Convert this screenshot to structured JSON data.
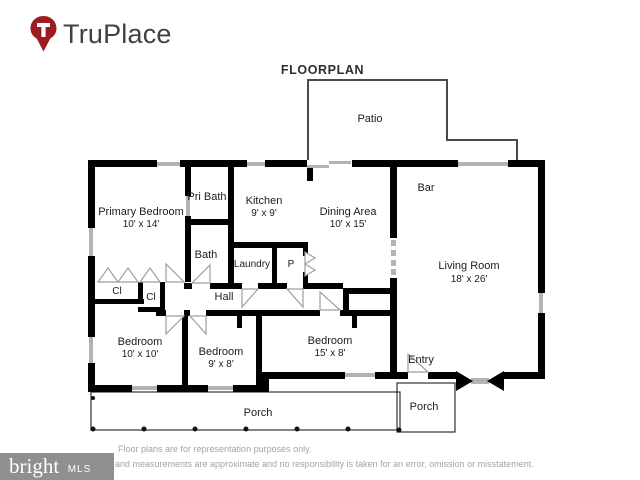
{
  "header": {
    "logo_text": "TruPlace"
  },
  "title": "FLOORPLAN",
  "rooms": {
    "patio": {
      "name": "Patio"
    },
    "bar": {
      "name": "Bar"
    },
    "pri_bath": {
      "name": "Pri Bath"
    },
    "kitchen": {
      "name": "Kitchen",
      "dims": "9' x 9'"
    },
    "dining": {
      "name": "Dining Area",
      "dims": "10' x 15'"
    },
    "primary_bedroom": {
      "name": "Primary Bedroom",
      "dims": "10' x 14'"
    },
    "bath": {
      "name": "Bath"
    },
    "laundry": {
      "name": "Laundry"
    },
    "pantry": {
      "name": "P"
    },
    "closet1": {
      "name": "Cl"
    },
    "closet2": {
      "name": "Cl"
    },
    "hall": {
      "name": "Hall"
    },
    "living_room": {
      "name": "Living Room",
      "dims": "18' x 26'"
    },
    "bedroom1": {
      "name": "Bedroom",
      "dims": "10' x 10'"
    },
    "bedroom2": {
      "name": "Bedroom",
      "dims": "9' x 8'"
    },
    "bedroom3": {
      "name": "Bedroom",
      "dims": "15' x 8'"
    },
    "entry": {
      "name": "Entry"
    },
    "porch_front": {
      "name": "Porch"
    },
    "porch_entry": {
      "name": "Porch"
    }
  },
  "footer": {
    "line1": "Floor plans are for representation purposes only.",
    "line2": "and measurements are approximate and no responsibility is taken for an error, omission or misstatement."
  },
  "watermark": {
    "brand": "bright",
    "star": "*",
    "suffix": "MLS"
  },
  "colors": {
    "wall": "#000000",
    "window": "#b3b3b3",
    "door_swing": "#9e9e9e",
    "logo_red": "#9d1c21",
    "watermark_star": "#e8762c"
  }
}
